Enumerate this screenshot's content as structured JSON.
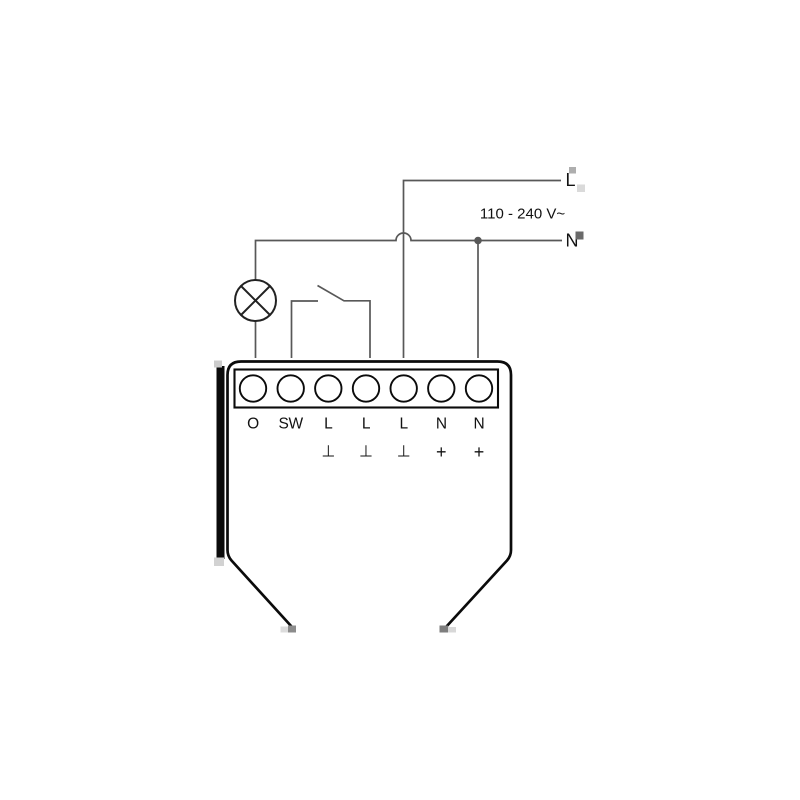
{
  "colors": {
    "wire": "#585858",
    "component": "#222222",
    "device": "#0b0b0b",
    "text": "#121212",
    "background": "#ffffff"
  },
  "supply": {
    "line_label": "L",
    "voltage_label": "110 - 240 V~",
    "neutral_label": "N"
  },
  "device": {
    "terminal_labels": [
      "O",
      "SW",
      "L",
      "L",
      "L",
      "N",
      "N"
    ],
    "terminal_marks": [
      "",
      "",
      "⊥",
      "⊥",
      "⊥",
      "+",
      "+"
    ]
  }
}
